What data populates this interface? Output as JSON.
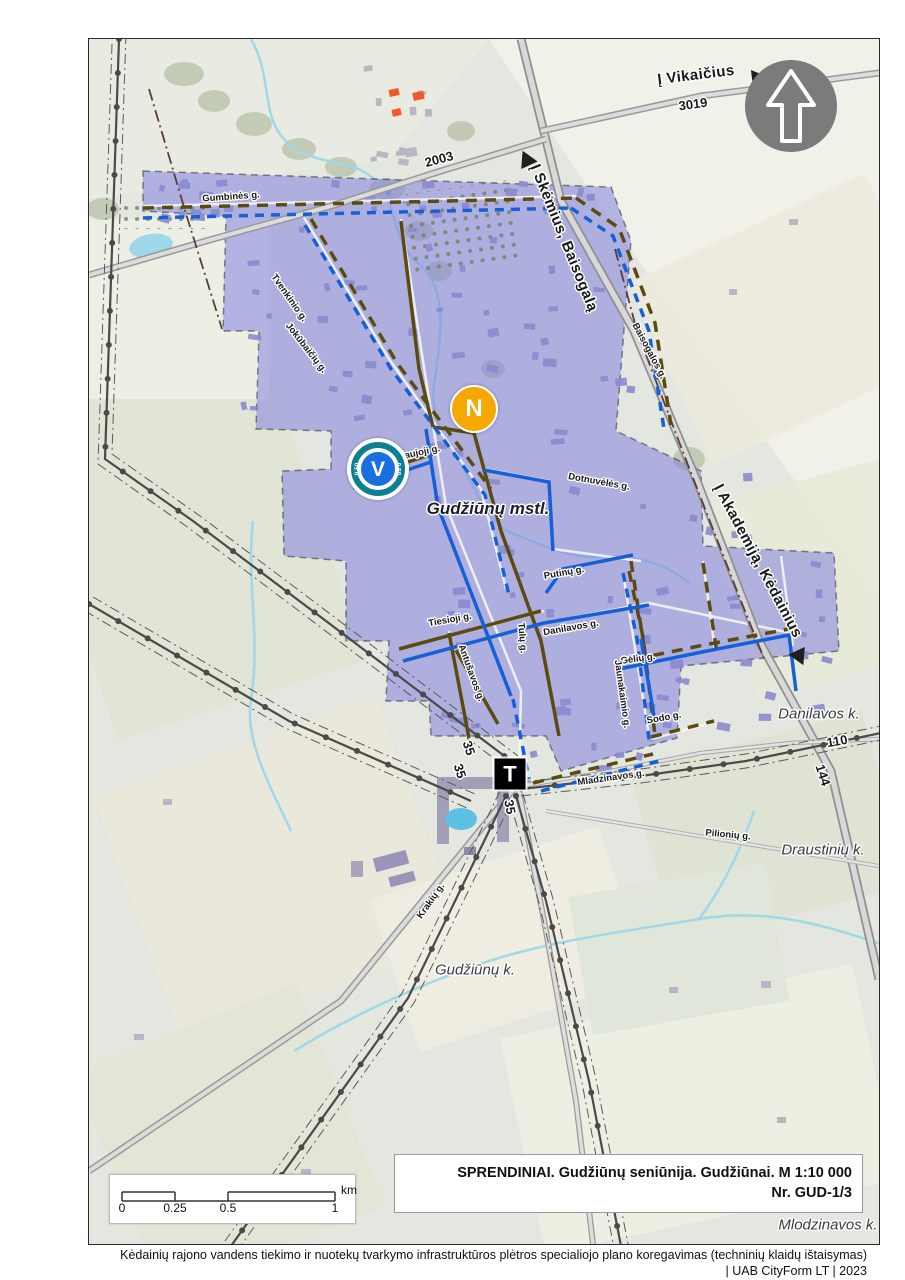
{
  "map": {
    "street_labels": [
      {
        "text": "Gumbinės g.",
        "x": 142,
        "y": 158,
        "rot": -4
      },
      {
        "text": "Tvenkinio g.",
        "x": 200,
        "y": 259,
        "rot": 55
      },
      {
        "text": "Jokūbaičių g.",
        "x": 217,
        "y": 309,
        "rot": 52
      },
      {
        "text": "Naujoji g.",
        "x": 330,
        "y": 414,
        "rot": -12
      },
      {
        "text": "Dotnuvėlės g.",
        "x": 510,
        "y": 443,
        "rot": 10
      },
      {
        "text": "Putinų g.",
        "x": 475,
        "y": 534,
        "rot": -10
      },
      {
        "text": "Tiesioji g.",
        "x": 361,
        "y": 581,
        "rot": -10
      },
      {
        "text": "Tulų g.",
        "x": 433,
        "y": 599,
        "rot": 85
      },
      {
        "text": "Danilavos g.",
        "x": 482,
        "y": 589,
        "rot": -10
      },
      {
        "text": "Gėlių g.",
        "x": 549,
        "y": 620,
        "rot": -8
      },
      {
        "text": "Jaunakaimio g.",
        "x": 533,
        "y": 655,
        "rot": 82
      },
      {
        "text": "Sodo g.",
        "x": 575,
        "y": 679,
        "rot": -10
      },
      {
        "text": "Antušavos g.",
        "x": 382,
        "y": 634,
        "rot": 70
      },
      {
        "text": "Mladzinavos g.",
        "x": 522,
        "y": 739,
        "rot": -8
      },
      {
        "text": "Pilionių g.",
        "x": 639,
        "y": 796,
        "rot": 5
      },
      {
        "text": "Krakių g.",
        "x": 342,
        "y": 862,
        "rot": -55
      },
      {
        "text": "Baisogalos g.",
        "x": 560,
        "y": 312,
        "rot": 62
      },
      {
        "text": "sti",
        "x": 689,
        "y": 50,
        "rot": -15
      }
    ],
    "road_numbers": [
      {
        "text": "3019",
        "x": 604,
        "y": 65,
        "rot": -8
      },
      {
        "text": "2003",
        "x": 350,
        "y": 120,
        "rot": -15
      },
      {
        "text": "110",
        "x": 748,
        "y": 702,
        "rot": -10
      },
      {
        "text": "144",
        "x": 734,
        "y": 736,
        "rot": 72
      },
      {
        "text": "35",
        "x": 380,
        "y": 709,
        "rot": 72
      },
      {
        "text": "35",
        "x": 371,
        "y": 732,
        "rot": 72
      },
      {
        "text": "35",
        "x": 421,
        "y": 768,
        "rot": 80
      }
    ],
    "place_labels": [
      {
        "text": "Gudžiūnų mstl.",
        "x": 399,
        "y": 470,
        "rot": 0,
        "bold": true
      },
      {
        "text": "Danilavos k.",
        "x": 730,
        "y": 675,
        "rot": 0
      },
      {
        "text": "Draustinių k.",
        "x": 734,
        "y": 811,
        "rot": 0
      },
      {
        "text": "Gudžiūnų k.",
        "x": 386,
        "y": 931,
        "rot": 0
      },
      {
        "text": "Mlodzinavos k.",
        "x": 739,
        "y": 1186,
        "rot": 0
      }
    ],
    "direction_labels": [
      {
        "text": "Į Vikaičius",
        "x": 607,
        "y": 36,
        "rot": -7,
        "arrow": {
          "x": 671,
          "y": 39,
          "rot": -7
        }
      },
      {
        "text": "Į Skėmius, Baisogalą",
        "x": 475,
        "y": 199,
        "rot": 68,
        "arrow": {
          "x": 437,
          "y": 119,
          "rot": -115
        }
      },
      {
        "text": "Į Akademiją, Kėdainius",
        "x": 669,
        "y": 522,
        "rot": 62,
        "arrow": {
          "x": 711,
          "y": 619,
          "rot": 65
        }
      }
    ],
    "markers": [
      {
        "letter": "N",
        "shape": "circle",
        "color": "#f6a800",
        "x": 385,
        "y": 370
      },
      {
        "letter": "V",
        "shape": "circle-ring",
        "color": "#1a6fdf",
        "ring_color": "#0d7f93",
        "ring_labels": [
          "0,50",
          "0,50"
        ],
        "x": 289,
        "y": 430
      },
      {
        "letter": "T",
        "shape": "square",
        "color": "#000000",
        "x": 421,
        "y": 735
      }
    ]
  },
  "scale_bar": {
    "ticks": [
      "0",
      "0.25",
      "0.5",
      "1"
    ],
    "unit": "km"
  },
  "title_block": {
    "line1": "SPRENDINIAI. Gudžiūnų seniūnija. Gudžiūnai. M 1:10 000",
    "line2": "Nr. GUD-1/3"
  },
  "footer": {
    "line1": "Kėdainių rajono vandens tiekimo ir nuotekų tvarkymo infrastruktūros plėtros specialiojo plano koregavimas (techninių klaidų ištaisymas)",
    "line2": "| UAB CityForm LT | 2023"
  },
  "colors": {
    "settlement_fill": "#7c7cde",
    "water_line_blue": "#1560d6",
    "sewer_line_brown": "#5c4a10",
    "stream": "#9fd8e8",
    "marker_n": "#f6a800",
    "marker_v": "#1a6fdf",
    "marker_v_ring": "#0d7f93",
    "marker_t": "#000000",
    "north_arrow_gray": "#7b7b7b"
  }
}
